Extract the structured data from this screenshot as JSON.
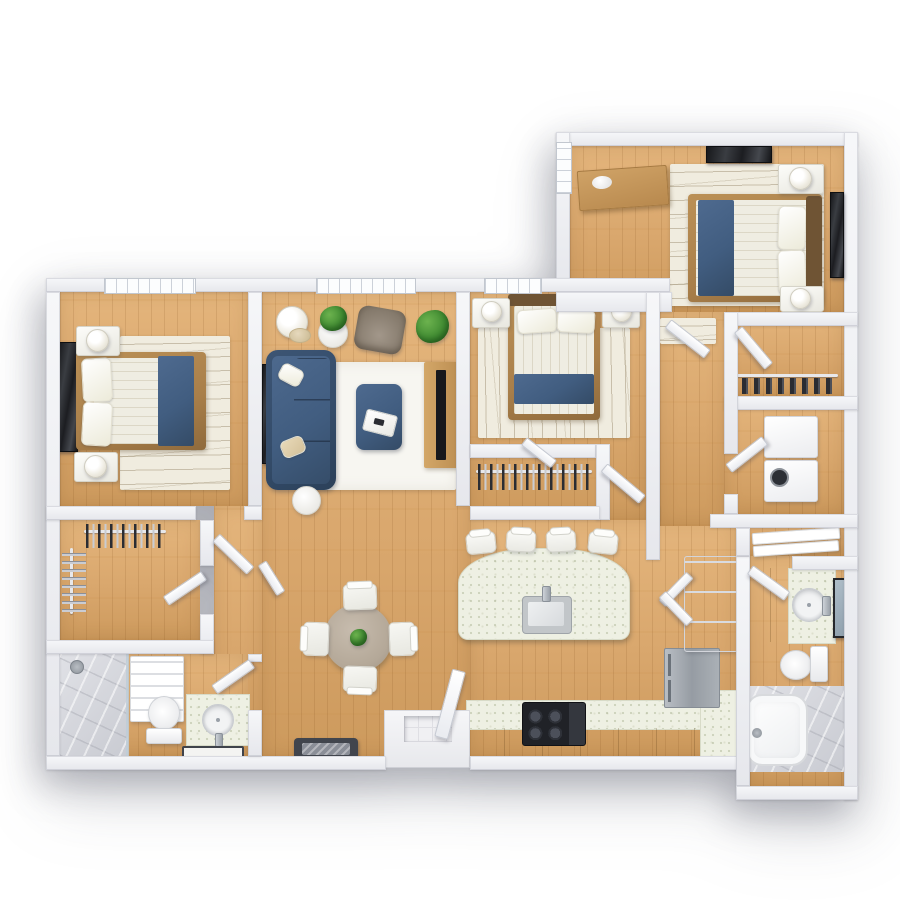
{
  "scene": {
    "kind": "3d-apartment-floor-plan-top-down-render",
    "background": "#ffffff",
    "text_labels": []
  },
  "palette": {
    "bg": "#ffffff",
    "wall": "#e6e7ec",
    "wallHi": "#f6f7f9",
    "wallEdge": "#c9ccd6",
    "wood": "#d9a76d",
    "woodHi": "#e4b57c",
    "woodLo": "#cd9a5d",
    "rug": "#f0ecdf",
    "rugLine": "#a99b7c",
    "rugWhite": "#f7f6f1",
    "navy": "#415d80",
    "navyHi": "#4e6a8f",
    "navyLo": "#344b66",
    "linen": "#efede2",
    "bedWood": "#a97f4a",
    "headboard": "#6f5434",
    "dark": "#1c1d21",
    "counter": "#eef0e3",
    "cabinet": "#c89a5c",
    "steel": "#a0a7ae",
    "marble": "#d6d7dc",
    "green": "#3f8a31",
    "taupe": "#b4a898",
    "tile": "#f0f0f3",
    "mat": "#41454d",
    "chrome": "#9aa1a9",
    "white": "#f6f6f3"
  },
  "rooms": [
    {
      "name": "bedroom-top-right",
      "floor": "wood",
      "furniture": [
        "double-bed-navy-runner",
        "nightstand x2",
        "table-lamp x2",
        "dresser-wood",
        "decor-bowl",
        "wall-art x2",
        "area-rug-waves",
        "window-left-wall"
      ]
    },
    {
      "name": "bedroom-left",
      "floor": "wood",
      "furniture": [
        "double-bed-navy-runner",
        "dark-headboard-panel",
        "nightstand x2",
        "table-lamp x2",
        "area-rug-waves",
        "window-top-wall"
      ]
    },
    {
      "name": "bedroom-center",
      "floor": "wood",
      "furniture": [
        "double-bed-navy-runner",
        "nightstand x2",
        "table-lamp x2",
        "area-rug-waves",
        "window-top-wall",
        "reach-in-closet-hangers"
      ]
    },
    {
      "name": "living-room",
      "floor": "wood",
      "furniture": [
        "navy-sofa",
        "throw-pillow x2",
        "navy-ottoman",
        "serving-tray",
        "grey-armchair",
        "floor-lamp",
        "potted-plant x2",
        "tv-console-wood",
        "flat-tv",
        "wall-media-shelf",
        "white-area-rug",
        "round-side-table",
        "window-top-wall"
      ]
    },
    {
      "name": "dining-area",
      "floor": "wood",
      "furniture": [
        "round-table-taupe",
        "dining-chair x4",
        "centerpiece-plant"
      ]
    },
    {
      "name": "kitchen",
      "floor": "wood",
      "furniture": [
        "island-curved-counter",
        "island-sink",
        "faucet",
        "bar-stool x4",
        "bottom-counter",
        "gas-stove",
        "refrigerator-steel",
        "pantry-cabinet-open-doors",
        "corner-counter"
      ]
    },
    {
      "name": "entry",
      "floor": "wood",
      "furniture": [
        "front-door-open",
        "entry-step",
        "doormat-dark"
      ]
    },
    {
      "name": "hallway-right",
      "floor": "wood",
      "furniture": [
        "runner-rug"
      ]
    },
    {
      "name": "walk-in-closet-left",
      "floor": "wood",
      "furniture": [
        "clothes-rail-front",
        "clothes-rail-side"
      ]
    },
    {
      "name": "closet-top-right",
      "floor": "wood",
      "furniture": [
        "shoe-rail"
      ]
    },
    {
      "name": "laundry-closet",
      "floor": "wood",
      "furniture": [
        "washer",
        "dryer"
      ]
    },
    {
      "name": "linen-closet",
      "floor": "wood",
      "furniture": [
        "shelf x2"
      ]
    },
    {
      "name": "bathroom-left",
      "floor": "wood",
      "furniture": [
        "marble-shower",
        "shower-head",
        "towel-shelf",
        "toilet",
        "vanity-round-sink",
        "faucet",
        "bath-mat"
      ]
    },
    {
      "name": "bathroom-right",
      "floor": "wood",
      "furniture": [
        "vanity-round-sink",
        "faucet",
        "mirror",
        "toilet",
        "bathtub-marble-deck",
        "tub-filler"
      ]
    }
  ],
  "windows": 4,
  "interior_doors": 11
}
